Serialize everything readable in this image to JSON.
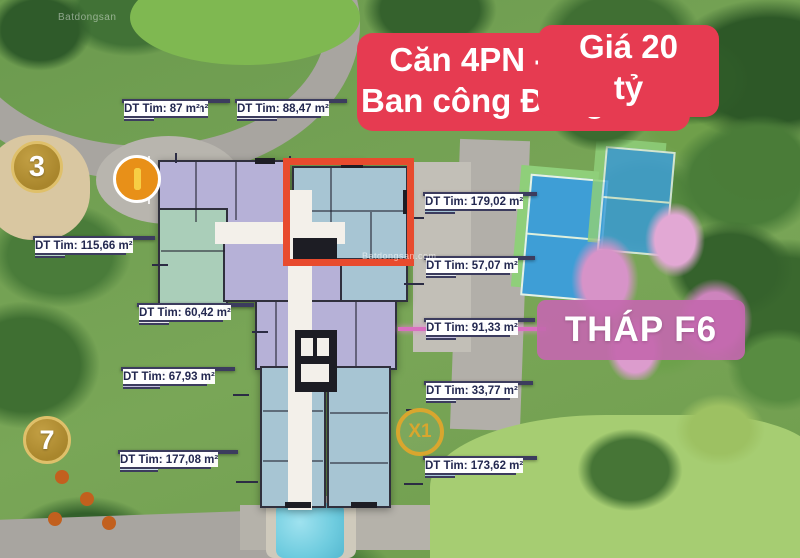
{
  "banner": {
    "line1": "Căn 4PN - 160m2",
    "line2": "Ban công Đông Nam",
    "line3": "Giá 20 tỷ",
    "bg_color": "#e63b51",
    "text_color": "#ffffff"
  },
  "tower_label": {
    "text": "THÁP F6",
    "bg_color": "#c368ae",
    "text_color": "#ffffff"
  },
  "badges": {
    "b3": {
      "text": "3"
    },
    "b7": {
      "text": "7"
    },
    "x1": {
      "text": "X1"
    }
  },
  "highlight": {
    "color": "#e84b2e"
  },
  "units": [
    {
      "id": "CH-3",
      "dt_tt": "DT TT: 76,16 m²",
      "dt_tim": "DT Tim: 87 m²"
    },
    {
      "id": "CH-3A",
      "dt_tt": "DT TT: 78,87 m²",
      "dt_tim": "DT Tim: 88,47 m²"
    },
    {
      "id": "CH-5",
      "dt_tt": "DT TT: 159,87 m²",
      "dt_tim": "DT Tim: 179,02 m²"
    },
    {
      "id": "CH-2",
      "dt_tt": "DT TT: 101,82 m²",
      "dt_tim": "DT Tim: 115,66 m²"
    },
    {
      "id": "CH-6",
      "dt_tt": "DT TT: 49,77 m²",
      "dt_tim": "DT Tim: 57,07 m²"
    },
    {
      "id": "CH-1",
      "dt_tt": "DT TT: 53,88 m²",
      "dt_tim": "DT Tim: 60,42 m²"
    },
    {
      "id": "CH-7",
      "dt_tt": "DT TT: 80,92 m²",
      "dt_tim": "DT Tim: 91,33 m²"
    },
    {
      "id": "CH-11",
      "dt_tt": "DT TT: 59,12 m²",
      "dt_tim": "DT Tim: 67,93 m²"
    },
    {
      "id": "CH-8",
      "dt_tt": "DT TT: 28,93 m²",
      "dt_tim": "DT Tim: 33,77 m²"
    },
    {
      "id": "CH-10",
      "dt_tt": "DT TT: 157,48 m²",
      "dt_tim": "DT Tim: 177,08 m²"
    },
    {
      "id": "CH-9",
      "dt_tt": "DT TT: 155,15 m²",
      "dt_tim": "DT Tim: 173,62 m²"
    }
  ],
  "watermarks": {
    "top_left": "Batdongsan",
    "center": "Batdongsan.com"
  },
  "colors": {
    "badge_gold": "#b5912f",
    "unit_blue": "#a7c5d3",
    "unit_lavender": "#b6b1d7",
    "unit_green": "#aaceb9"
  }
}
